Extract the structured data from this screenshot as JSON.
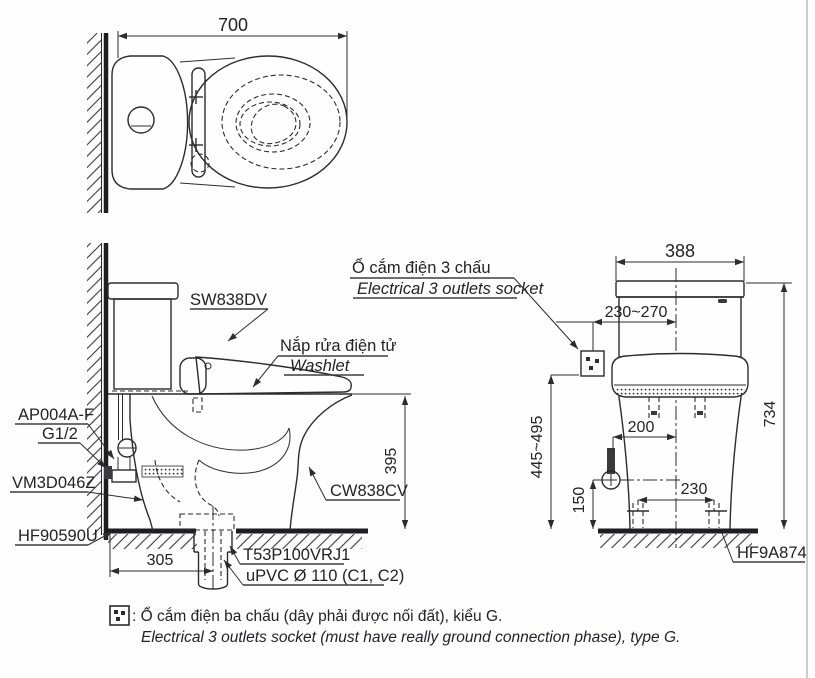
{
  "colors": {
    "line": "#2b2b30",
    "text": "#222228",
    "background": "#ffffff"
  },
  "top_view": {
    "width_dim": "700"
  },
  "side_view": {
    "tank_code": "SW838DV",
    "washlet_vi": "Nắp rửa điện tử",
    "washlet_en": "Washlet",
    "supply_code": "AP004A-F",
    "thread_size": "G1/2",
    "valve_code": "VM3D046Z",
    "flange_code": "HF90590U",
    "bowl_code": "CW838CV",
    "rim_height_dim": "395",
    "rough_in_dim": "305",
    "drain_code": "T53P100VRJ1",
    "pipe_spec": "uPVC Ø 110 (C1, C2)"
  },
  "front_view": {
    "socket_vi": "Ổ cắm điện 3 chấu",
    "socket_en": "Electrical 3 outlets socket",
    "tank_width_dim": "388",
    "socket_offset_dim": "230~270",
    "socket_height_dim": "445~495",
    "total_height_dim": "734",
    "supply_offset_dim": "200",
    "supply_height_dim": "150",
    "bolt_spacing_dim": "230",
    "seal_code": "HF9A874"
  },
  "footnote": {
    "vi": ": Ổ cắm điện ba chấu (dây phải được nối đất), kiểu G.",
    "en": "Electrical 3 outlets socket (must have really ground connection phase), type G."
  }
}
